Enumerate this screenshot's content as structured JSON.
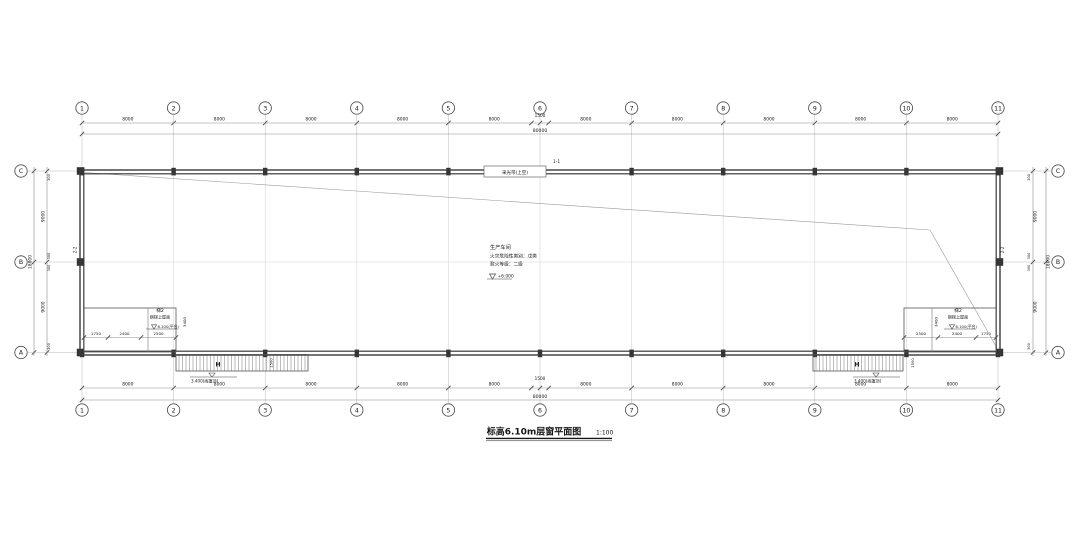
{
  "drawing": {
    "title": "标高6.10m层窗平面图",
    "scale": "1:100"
  },
  "grid": {
    "column_axes": [
      "1",
      "2",
      "3",
      "4",
      "5",
      "6",
      "7",
      "8",
      "9",
      "10",
      "11"
    ],
    "row_axes": [
      "C",
      "B",
      "A"
    ],
    "bay_width": "8000",
    "total_width": "80000",
    "bay_height": "9000",
    "total_height": "18000",
    "edge_offset": "300",
    "axis6_dim": "1500"
  },
  "notes": {
    "room_use": "生产车间",
    "fire_hazard": "火灾危险性类别：戊类",
    "fire_rating": "耐火等级：二级",
    "floor_elevation": "+6.000",
    "roof_strip_label": "采光带(上空)",
    "section_1": "1-1",
    "section_2": "2-2"
  },
  "stair_left": {
    "name": "梯2",
    "note": "钢梯上屋面",
    "platform_elevation": "6.100(平台)",
    "width_dims": [
      "1750",
      "2400",
      "2500"
    ],
    "depth_dim": "3400"
  },
  "stair_right": {
    "name": "梯2",
    "note": "钢梯上屋面",
    "platform_elevation": "6.100(平台)",
    "width_dims": [
      "2500",
      "2400",
      "1750"
    ],
    "depth_dim": "3400"
  },
  "canopy_left": {
    "elevation_label": "3.400(雨篷顶)",
    "depth_dim": "1500",
    "ladder_mark": "H"
  },
  "canopy_right": {
    "elevation_label": "3.400(雨篷顶)",
    "depth_dim": "1500",
    "ladder_mark": "H"
  },
  "colors": {
    "wall": "#3a3a3a",
    "dim_line": "#8a8a8a",
    "ext_line": "#b8b8b8",
    "grid_line": "#d4d4d4",
    "text": "#161616",
    "background": "#ffffff"
  }
}
